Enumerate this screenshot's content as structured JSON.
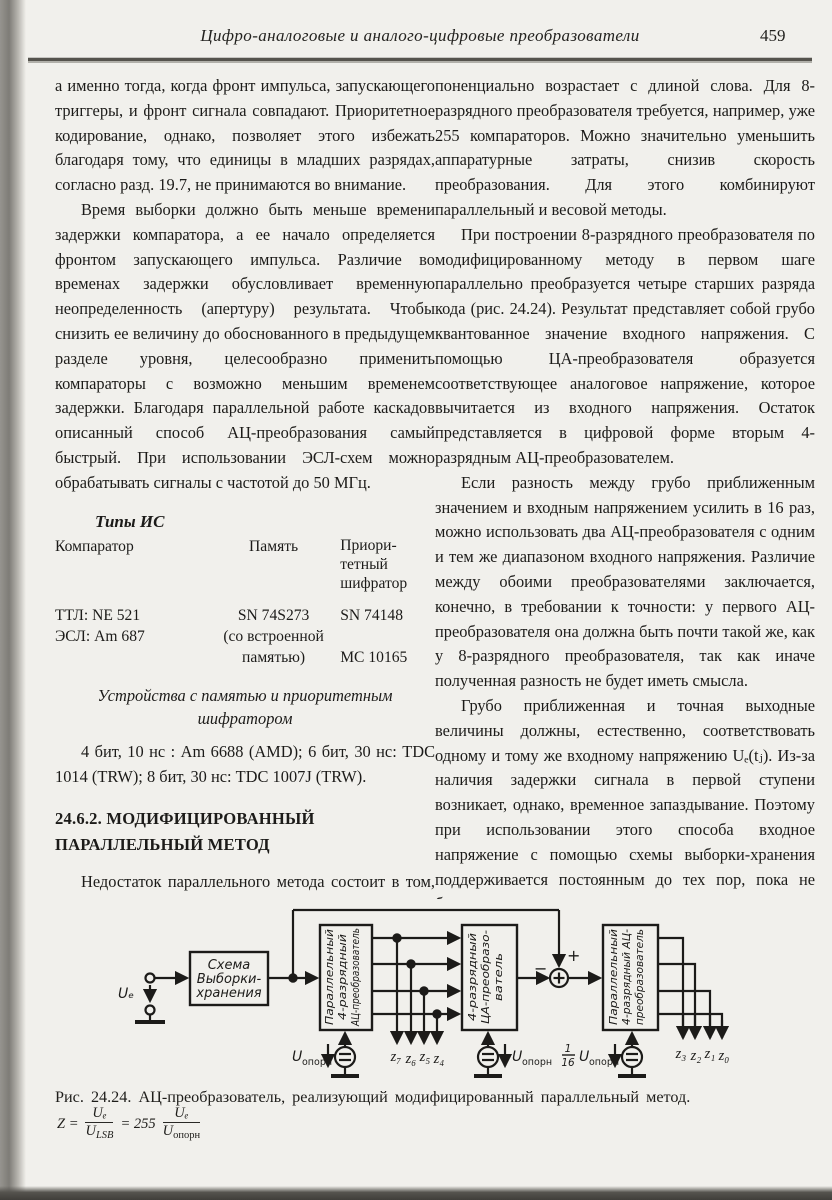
{
  "header": {
    "title": "Цифро-аналоговые и аналого-цифровые преобразователи",
    "page_number": "459"
  },
  "left_column": {
    "para1": "а именно тогда, когда фронт импульса, запускающего триггеры, и фронт сигнала совпадают. Приоритетное кодирование, однако, позволяет этого избежать благодаря тому, что единицы в младших разрядах, согласно разд. 19.7, не принимаются во внимание.",
    "para2": "Время выборки должно быть меньше времени задержки компаратора, а ее начало определяется фронтом запускающего импульса. Различие во временах задержки обусловливает временную неопределенность (апертуру) результата. Чтобы снизить ее величину до обоснованного в предыдущем разделе уровня, целесообразно применить компараторы с возможно меньшим временем задержки. Благодаря параллельной работе каскадов описанный способ АЦ-преобразования самый быстрый. При использовании ЭСЛ-схем можно обрабатывать сигналы с частотой до 50 МГц.",
    "ic_table": {
      "title": "Типы ИС",
      "col1_header": "Компаратор",
      "col2_header": "Память",
      "col3_header_lines": [
        "Приори-",
        "тетный",
        "шифратор"
      ],
      "rows": [
        [
          "ТТЛ: NE 521",
          "SN 74S273",
          "SN 74148"
        ],
        [
          "ЭСЛ: Am 687",
          "(со встроенной памятью)",
          "MC 10165"
        ]
      ]
    },
    "memory_heading": "Устройства с памятью и приоритетным шифратором",
    "para3": "4 бит, 10 нс : Am 6688 (AMD); 6 бит, 30 нс: TDC 1014 (TRW); 8 бит, 30 нс: TDC 1007J (TRW).",
    "section_heading": "24.6.2. МОДИФИЦИРОВАННЫЙ ПАРАЛЛЕЛЬНЫЙ МЕТОД",
    "para4": "Недостаток параллельного метода состоит в том, что число компараторов экс-"
  },
  "right_column": {
    "para1": "поненциально возрастает с длиной слова. Для 8-разрядного преобразователя требуется, например, уже 255 компараторов. Можно значительно уменьшить аппаратурные затраты, снизив скорость преобразования. Для этого комбинируют параллельный и весовой методы.",
    "para2": "При построении 8-разрядного преобразователя по модифицированному методу в первом шаге параллельно преобразуется четыре старших разряда кода (рис. 24.24). Результат представляет собой грубо квантованное значение входного напряжения. С помощью ЦА-преобразователя образуется соответствующее аналоговое напряжение, которое вычитается из входного напряжения. Остаток представляется в цифровой форме вторым 4-разрядным АЦ-преобразователем.",
    "para3": "Если разность между грубо приближенным значением и входным напряжением усилить в 16 раз, можно использовать два АЦ-преобразователя с одним и тем же диапазоном входного напряжения. Различие между обоими преобразователями заключается, конечно, в требовании к точности: у первого АЦ-преобразователя она должна быть почти такой же, как у 8-разрядного преобразователя, так как иначе полученная разность не будет иметь смысла.",
    "para4": "Грубо приближенная и точная выходные величины должны, естественно, соответствовать одному и тому же входному напряжению Uₑ(tⱼ). Из-за наличия задержки сигнала в первой ступени возникает, однако, временное запаздывание. Поэтому при использовании этого способа входное напряжение с помощью схемы выборки-хранения поддерживается постоянным до тех пор, пока не будет получено все число."
  },
  "diagram": {
    "input_label": "Uₑ",
    "sh_lines": [
      "Схема",
      "Выборки-",
      "хранения"
    ],
    "adc1_lines": [
      "Параллельный",
      "4-разрядный",
      "АЦ-преобразователь"
    ],
    "dac_lines": [
      "4-разрядный",
      "ЦА-преобразо-",
      "ватель"
    ],
    "adc2_lines": [
      "Параллельный",
      "4-разрядный АЦ-",
      "преобразователь"
    ],
    "bits_high": [
      "z₇",
      "z₆",
      "z₅",
      "z₄"
    ],
    "bits_low": [
      "z₃",
      "z₂",
      "z₁",
      "z₀"
    ],
    "vref_base": "U",
    "vref_sub": "опорн",
    "vref3_frac_num": "1",
    "vref3_frac_den": "16",
    "sum_plus": "+",
    "sum_minus": "−"
  },
  "caption": "Рис. 24.24. АЦ-преобразователь, реализующий модифицированный параллельный метод.",
  "formula": {
    "lhs": "Z =",
    "num1": "Uₑ",
    "den1_base": "U",
    "den1_sub": "LSB",
    "mid": "= 255",
    "num2": "Uₑ",
    "den2_base": "U",
    "den2_sub": "опорн"
  }
}
